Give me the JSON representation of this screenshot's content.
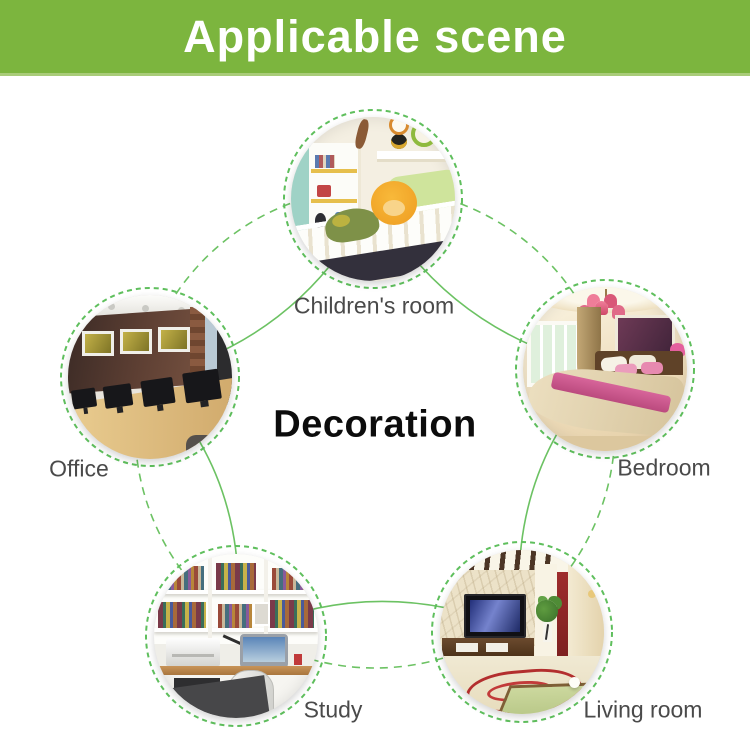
{
  "header": {
    "title": "Applicable scene"
  },
  "center_label": "Decoration",
  "scenes": [
    {
      "id": "childrens-room",
      "label": "Children's room"
    },
    {
      "id": "office",
      "label": "Office"
    },
    {
      "id": "bedroom",
      "label": "Bedroom"
    },
    {
      "id": "study",
      "label": "Study"
    },
    {
      "id": "living-room",
      "label": "Living room"
    }
  ],
  "colors": {
    "banner_green": "#7cb53e",
    "connector_green": "#6cc263",
    "ring_green": "#5fbf5d",
    "label_text": "#4a4a4a",
    "center_text": "#0c0c0c",
    "banner_text": "#ffffff"
  }
}
